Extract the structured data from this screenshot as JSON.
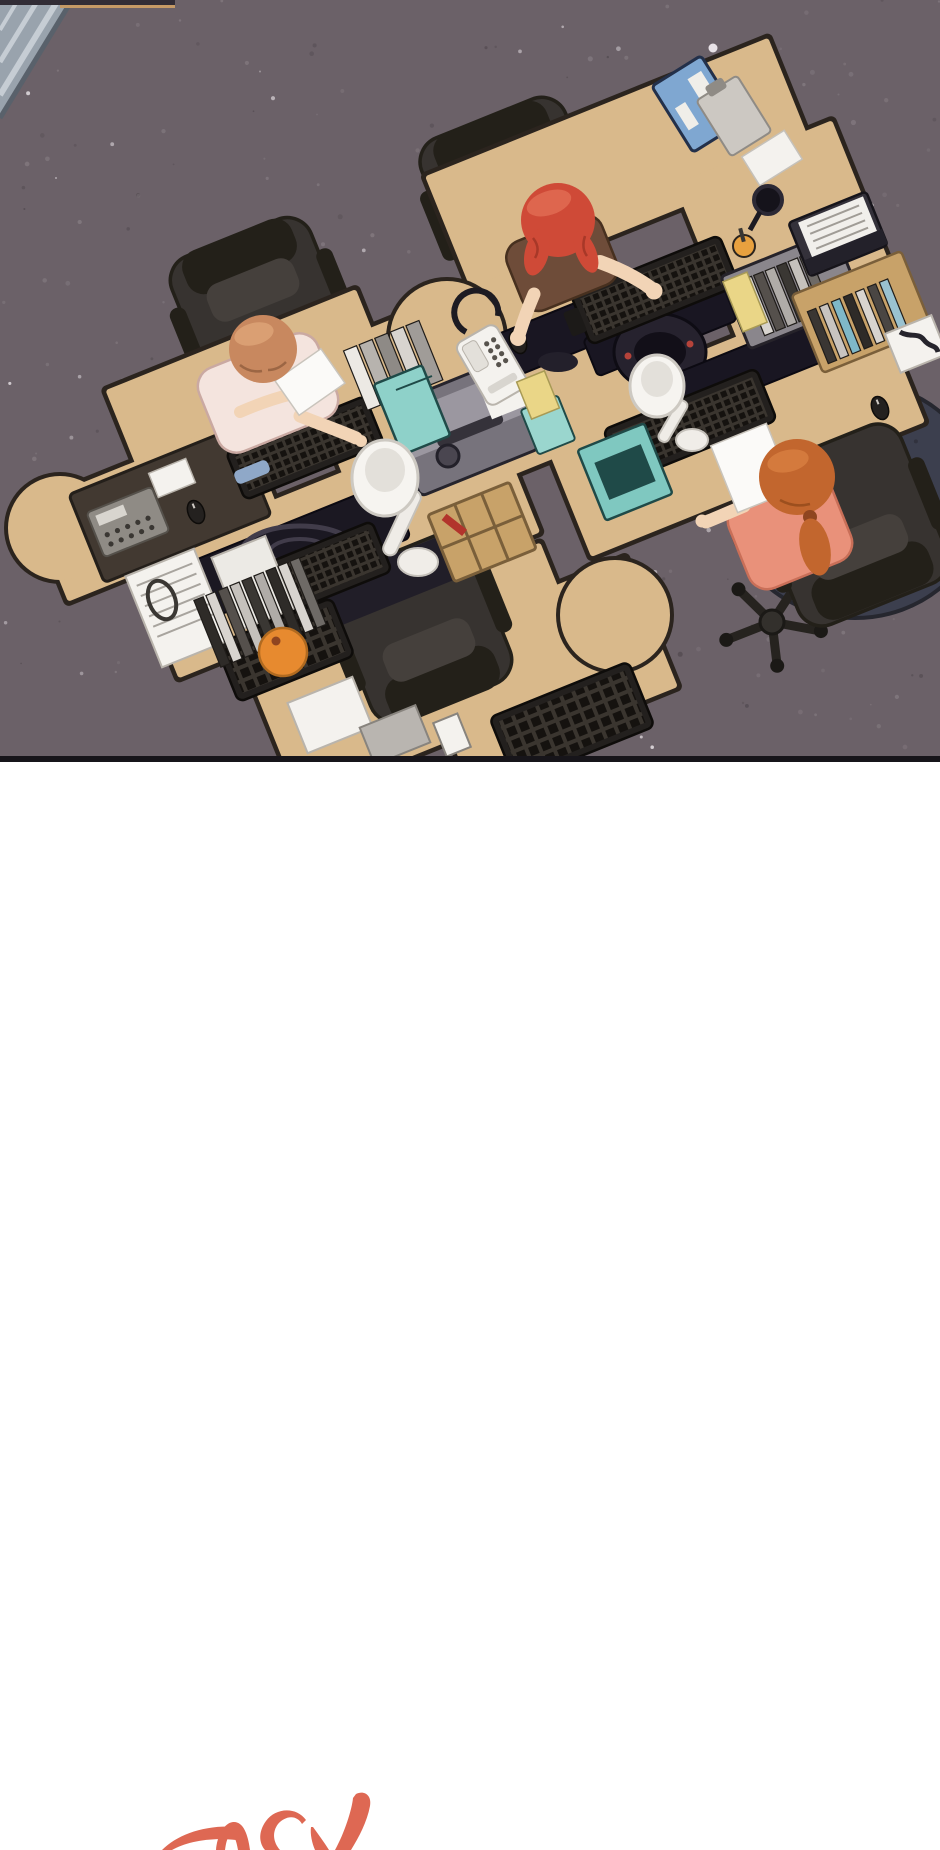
{
  "scene": {
    "alt": "Top-down webtoon panel of an office: four wooden workstations pushed together on dark speckled carpet. A red-haired woman in a brown shirt types at the top desk, an auburn-haired employee in a pink cardigan reads a document at the left desk, and an orange-haired woman with a ponytail in a coral top reviews papers at the right desk. The fourth station is empty. Desks are covered with keyboards, monitors, a corded phone, a copier, binders, teal file boxes, lamps and books.",
    "workstations": 4,
    "people": [
      {
        "name": "employee-red-hair",
        "hair_color": "#cf4a37",
        "shirt_color": "#6e4c39",
        "activity": "typing on keyboard"
      },
      {
        "name": "employee-auburn-hair",
        "hair_color": "#c8885f",
        "shirt_color": "#f4e4de",
        "activity": "reading a document"
      },
      {
        "name": "employee-orange-ponytail",
        "hair_color": "#c2662e",
        "shirt_color": "#e9917a",
        "activity": "reviewing papers"
      }
    ]
  },
  "lettering": {
    "text": "TICK",
    "color": "#de6853"
  },
  "palette": {
    "background": "#ffffff",
    "carpet": "#6b6168",
    "speckle_light": "#837a80",
    "speckle_dark": "#544c52",
    "speckle_white": "#e9e4e8",
    "desk": "#d9b98b",
    "desk_ink": "#2b241e",
    "chair": "#373330",
    "chair_dark": "#232019",
    "skin": "#f2d4b6",
    "hair_red": "#cf4a37",
    "hair_red_light": "#e06b52",
    "hair_auburn": "#c8885f",
    "hair_auburn_light": "#dca275",
    "hair_orange": "#c2662e",
    "hair_orange_light": "#d67c3f",
    "shirt_brown": "#6e4c39",
    "cardigan_pink": "#f4e4de",
    "shirt_coral": "#e9917a",
    "jeans_blue": "#8fa8c8",
    "keyboard": "#23201e",
    "monitor": "#191622",
    "teal_box": "#8ed1c9",
    "machine_gray": "#8e8a93",
    "white_item": "#f4f2ee",
    "wood": "#c8a269",
    "rug_navy": "#3c3f4e",
    "dot_green": "#3fc43e",
    "folder_yellow": "#ead687",
    "binder_blue": "#7fa7d1",
    "fruit_orange": "#e78a2f",
    "lettering_red": "#de6853",
    "panel_border": "#17151a",
    "blinds": "#99a3ad"
  }
}
